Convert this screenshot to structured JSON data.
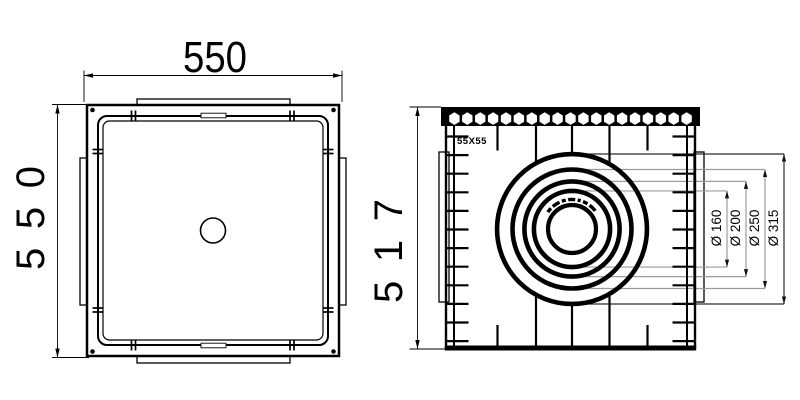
{
  "colors": {
    "line": "#000000",
    "leader": "#9c9c9c",
    "leader_dark": "#2a2a2a",
    "background": "#ffffff"
  },
  "top_view": {
    "width_label": "550",
    "height_label": "550"
  },
  "side_view": {
    "height_label": "517",
    "grate_mesh_label": "55X55",
    "hex_hole_count": 19,
    "wall_rib_count": 12,
    "scale_px_per_mm": 0.476,
    "pipe_diameters": [
      {
        "label": "Ø 160",
        "mm": 160
      },
      {
        "label": "Ø 200",
        "mm": 200
      },
      {
        "label": "Ø 250",
        "mm": 250
      },
      {
        "label": "Ø 315",
        "mm": 315
      }
    ]
  }
}
